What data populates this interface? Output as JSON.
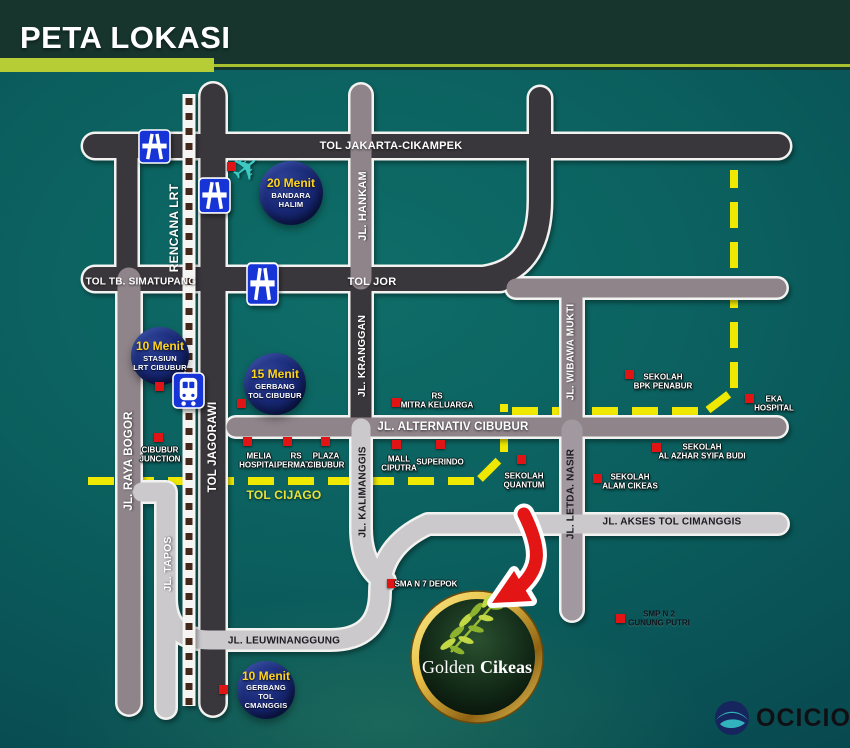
{
  "header": {
    "title": "PETA LOKASI"
  },
  "colors": {
    "accent_green": "#b7cd36",
    "header_bg": "#17352d",
    "map_teal": "#0b5f5e",
    "toll_dark": "#3a373c",
    "road_mauve": "#8e8489",
    "road_light": "#cbc9cc",
    "planned_yellow": "#efe800",
    "marker_red": "#e01414",
    "badge_navy": "#16246c",
    "gold": "#e9c34a"
  },
  "map": {
    "road_labels": [
      {
        "id": "tol-jakarta-cikampek",
        "text": "TOL JAKARTA-CIKAMPEK",
        "x": 391,
        "y": 146,
        "rot": 0,
        "color": "#ffffff",
        "size": 11,
        "shadow": true
      },
      {
        "id": "tol-tb-simatupang",
        "text": "TOL TB. SIMATUPANG",
        "x": 141,
        "y": 282,
        "rot": 0,
        "color": "#ffffff",
        "size": 10,
        "shadow": true
      },
      {
        "id": "tol-jor",
        "text": "TOL JOR",
        "x": 372,
        "y": 282,
        "rot": 0,
        "color": "#ffffff",
        "size": 11,
        "shadow": true
      },
      {
        "id": "rencana-lrt",
        "text": "RENCANA LRT",
        "x": 174,
        "y": 228,
        "rot": -90,
        "color": "#ffffff",
        "size": 12,
        "shadow": true
      },
      {
        "id": "jl-hankam",
        "text": "JL. HANKAM",
        "x": 363,
        "y": 206,
        "rot": -90,
        "color": "#ffffff",
        "size": 11,
        "shadow": true
      },
      {
        "id": "jl-kranggan",
        "text": "JL. KRANGGAN",
        "x": 362,
        "y": 356,
        "rot": -90,
        "color": "#ffffff",
        "size": 10.5,
        "shadow": true
      },
      {
        "id": "jl-raya-bogor",
        "text": "JL. RAYA BOGOR",
        "x": 129,
        "y": 461,
        "rot": -90,
        "color": "#ffffff",
        "size": 11.5,
        "shadow": true
      },
      {
        "id": "tol-jagorawi",
        "text": "TOL JAGORAWI",
        "x": 213,
        "y": 447,
        "rot": -90,
        "color": "#ffffff",
        "size": 11.5,
        "shadow": true
      },
      {
        "id": "jl-wibawa-mukti",
        "text": "JL. WIBAWA MUKTI",
        "x": 571,
        "y": 352,
        "rot": -90,
        "color": "#ffffff",
        "size": 10,
        "shadow": true
      },
      {
        "id": "jl-alternativ-cibubur",
        "text": "JL. ALTERNATIV CIBUBUR",
        "x": 453,
        "y": 427,
        "rot": 0,
        "color": "#ffffff",
        "size": 11.5,
        "shadow": true
      },
      {
        "id": "jl-kalimanggis",
        "text": "JL. KALIMANGGIS",
        "x": 363,
        "y": 492,
        "rot": -90,
        "color": "#1d1a22",
        "size": 10,
        "shadow": false
      },
      {
        "id": "jl-letda-nasir",
        "text": "JL. LETDA. NASIR",
        "x": 571,
        "y": 494,
        "rot": -90,
        "color": "#1d1a22",
        "size": 10,
        "shadow": false
      },
      {
        "id": "tol-cijago",
        "text": "TOL CIJAGO",
        "x": 284,
        "y": 495,
        "rot": 0,
        "color": "#e8e23a",
        "size": 12,
        "shadow": true
      },
      {
        "id": "jl-tapos",
        "text": "JL. TAPOS",
        "x": 168,
        "y": 564,
        "rot": -90,
        "color": "#ffffff",
        "size": 10.5,
        "shadow": true
      },
      {
        "id": "jl-leuwinanggung",
        "text": "JL. LEUWINANGGUNG",
        "x": 284,
        "y": 641,
        "rot": 0,
        "color": "#1d1a22",
        "size": 10,
        "shadow": false
      },
      {
        "id": "jl-akses-tol-cimanggis",
        "text": "JL. AKSES TOL CIMANGGIS",
        "x": 672,
        "y": 522,
        "rot": 0,
        "color": "#1d1a22",
        "size": 10,
        "shadow": false
      }
    ],
    "badges": [
      {
        "id": "bandara-halim",
        "minutes": "20 Menit",
        "lines": [
          "BANDARA",
          "HALIM"
        ],
        "x": 291,
        "y": 193,
        "r": 32
      },
      {
        "id": "stasiun-lrt-cibubur",
        "minutes": "10 Menit",
        "lines": [
          "STASIUN",
          "LRT CIBUBUR"
        ],
        "x": 160,
        "y": 356,
        "r": 29
      },
      {
        "id": "gerbang-tol-cibubur",
        "minutes": "15 Menit",
        "lines": [
          "GERBANG",
          "TOL CIBUBUR"
        ],
        "x": 275,
        "y": 384,
        "r": 31
      },
      {
        "id": "gerbang-tol-cmanggis",
        "minutes": "10 Menit",
        "lines": [
          "GERBANG",
          "TOL CMANGGIS"
        ],
        "x": 266,
        "y": 690,
        "r": 29
      }
    ],
    "landmarks": [
      {
        "id": "bandara-halim-marker",
        "sq": [
          227,
          162
        ]
      },
      {
        "id": "stasiun-lrt-marker",
        "sq": [
          155,
          382
        ]
      },
      {
        "id": "gerbang-tol-cibubur-marker",
        "sq": [
          237,
          399
        ]
      },
      {
        "id": "gerbang-tol-cmanggis-marker",
        "sq": [
          219,
          685
        ]
      },
      {
        "id": "cibubur-junction",
        "lines": [
          "CIBUBUR",
          "JUNCTION"
        ],
        "sq": [
          154,
          433
        ],
        "lx": 160,
        "ly": 455
      },
      {
        "id": "melia-hospital",
        "lines": [
          "MELIA",
          "HOSPITAL"
        ],
        "sq": [
          243,
          437
        ],
        "lx": 259,
        "ly": 461
      },
      {
        "id": "rs-permata",
        "lines": [
          "RS",
          "PERMATA"
        ],
        "sq": [
          283,
          437
        ],
        "lx": 296,
        "ly": 461
      },
      {
        "id": "plaza-cibubur",
        "lines": [
          "PLAZA",
          "CIBUBUR"
        ],
        "sq": [
          321,
          437
        ],
        "lx": 326,
        "ly": 461
      },
      {
        "id": "mall-ciputra",
        "lines": [
          "MALL",
          "CIPUTRA"
        ],
        "sq": [
          392,
          440
        ],
        "lx": 399,
        "ly": 464
      },
      {
        "id": "superindo",
        "lines": [
          "SUPERINDO"
        ],
        "sq": [
          436,
          440
        ],
        "lx": 440,
        "ly": 462
      },
      {
        "id": "rs-mitra-keluarga",
        "lines": [
          "RS",
          "MITRA KELUARGA"
        ],
        "sq": [
          392,
          398
        ],
        "lx": 437,
        "ly": 401
      },
      {
        "id": "sekolah-quantum",
        "lines": [
          "SEKOLAH",
          "QUANTUM"
        ],
        "sq": [
          517,
          455
        ],
        "lx": 524,
        "ly": 481
      },
      {
        "id": "sekolah-bpk-penabur",
        "lines": [
          "SEKOLAH",
          "BPK PENABUR"
        ],
        "sq": [
          625,
          370
        ],
        "lx": 663,
        "ly": 382
      },
      {
        "id": "eka-hospital",
        "lines": [
          "EKA",
          "HOSPITAL"
        ],
        "sq": [
          745,
          394
        ],
        "lx": 774,
        "ly": 404
      },
      {
        "id": "sekolah-al-azhar-syifa-budi",
        "lines": [
          "SEKOLAH",
          "AL AZHAR SYIFA BUDI"
        ],
        "sq": [
          652,
          443
        ],
        "lx": 702,
        "ly": 452
      },
      {
        "id": "sekolah-alam-cikeas",
        "lines": [
          "SEKOLAH",
          "ALAM CIKEAS"
        ],
        "sq": [
          593,
          474
        ],
        "lx": 630,
        "ly": 482
      },
      {
        "id": "sma-n-7-depok",
        "lines": [
          "SMA N 7 DEPOK"
        ],
        "sq": [
          387,
          579
        ],
        "lx": 426,
        "ly": 584
      },
      {
        "id": "smp-n-2-gunung-putri",
        "lines": [
          "SMP N 2",
          "GUNUNG PUTRI"
        ],
        "sq": [
          616,
          614
        ],
        "dark": true,
        "lx": 659,
        "ly": 619
      }
    ],
    "icons": {
      "highway": [
        {
          "x": 138,
          "y": 129,
          "h": 35
        },
        {
          "x": 198,
          "y": 177,
          "h": 37
        },
        {
          "x": 246,
          "y": 262,
          "h": 44
        }
      ],
      "train": {
        "x": 172,
        "y": 372
      },
      "plane": {
        "x": 232,
        "y": 152,
        "glyph": "✈"
      }
    }
  },
  "logo": {
    "word1": "Golden",
    "word2": "Cikeas"
  },
  "watermark": {
    "text": "OCICIO"
  }
}
